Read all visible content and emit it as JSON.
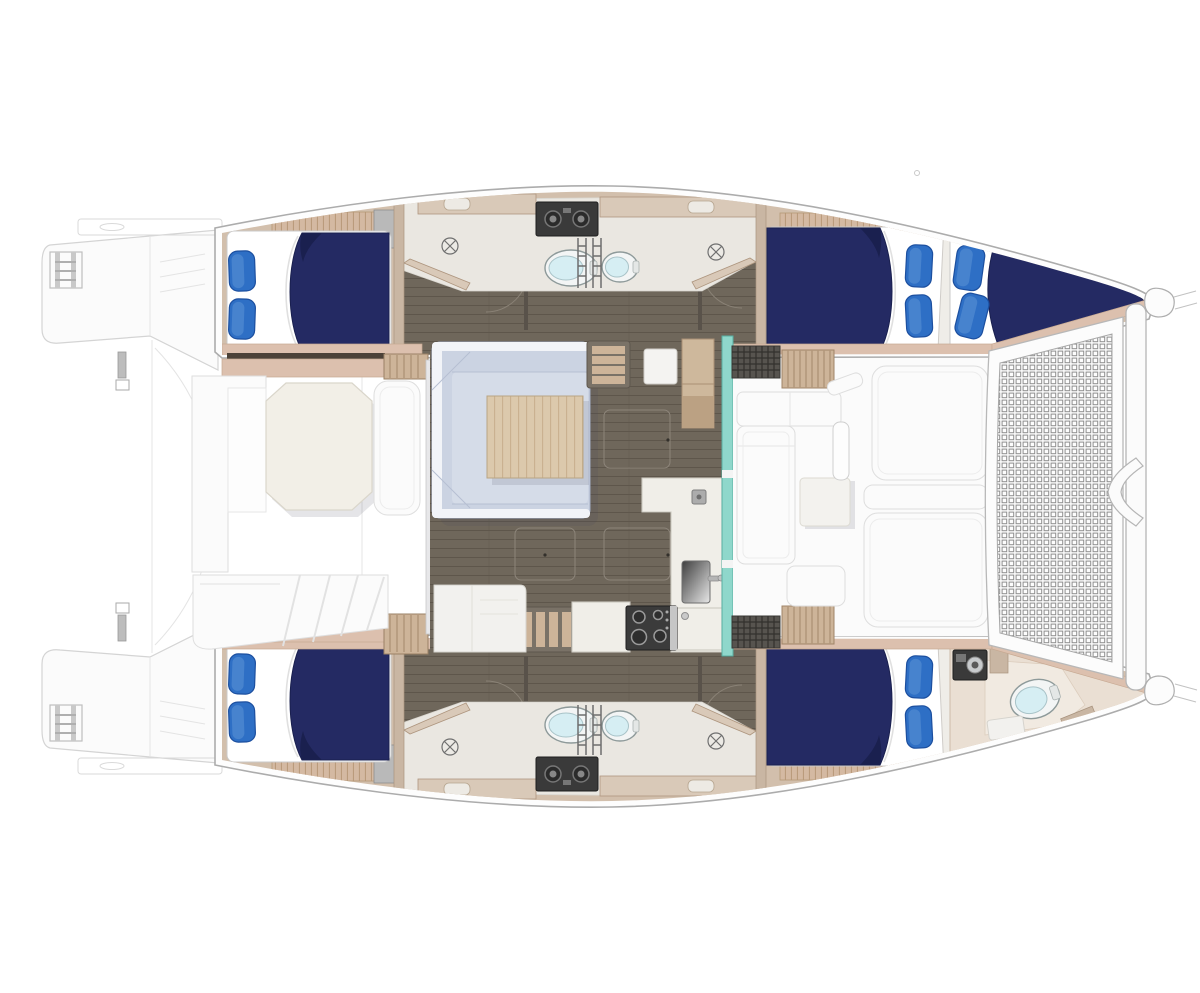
{
  "meta": {
    "diagram_type": "yacht-floor-plan",
    "vessel_type": "sailing-catamaran",
    "view": "top-down-deck-plan",
    "bow_direction": "right",
    "stern_direction": "left"
  },
  "palette": {
    "deck-white": "#FBFBFB",
    "deck-line": "#DEDEDE",
    "ghost-line": "#D4D4D4",
    "hull-stroke": "#ACACAC",
    "bed-navy": "#242A63",
    "bed-navy-dark": "#1A204F",
    "pillow-blue": "#2E6FC5",
    "pillow-blue-dark": "#1C4F9F",
    "wood-floor": "#6F675B",
    "wood-floor-line": "#5E564B",
    "wall-beige": "#D2BFAC",
    "wall-beige-dark": "#AE967F",
    "band-tan": "#DCC0AE",
    "slat-wood": "#D4B9A2",
    "slat-line": "#B89878",
    "step-wood": "#CDB499",
    "step-frame": "#7A7267",
    "bath-floor": "#EAE7E1",
    "fixture-beige": "#D9C9B8",
    "toilet-rim": "#F3F5F5",
    "toilet-bowl": "#D6EEF3",
    "toilet-stroke": "#8E9A9A",
    "sofa-blue": "#CBD3E2",
    "sofa-blue-light": "#D5DCE8",
    "sofa-stroke": "#A4AFC6",
    "table-wood": "#DCC9AC",
    "table-grain": "#C9B08E",
    "counter-white": "#F0EEE8",
    "counter-stroke": "#CCC9C1",
    "stove-dark": "#3B3B3B",
    "teal-glass": "#8FD7CB",
    "teal-stroke": "#58AFA2",
    "dark-panel": "#3A3A3A",
    "grate-dark": "#57544F",
    "head-floor": "#EADFD3",
    "tramp-line": "#8F8F8F"
  },
  "areas": [
    "stern-swim-platforms",
    "aft-cockpit",
    "saloon",
    "galley",
    "forward-deck-lounge",
    "bow-trampoline",
    "bow-crossbeam",
    "starboard-aft-cabin",
    "starboard-head-compartments",
    "starboard-forward-cabin",
    "forepeak-berth",
    "port-aft-cabin",
    "port-head-compartments",
    "port-forward-cabin",
    "forepeak-head"
  ],
  "counts": {
    "double-berths": 5,
    "pillows": 10,
    "toilets": 5,
    "shower-drains": 4,
    "head-compartments": 5,
    "boarding-ladders": 2,
    "sunpads": 3,
    "cockpit-tables": 1,
    "saloon-tables": 1,
    "stove-burners": 4
  },
  "icons": [
    "toilet-icon",
    "shower-drain-icon",
    "sink-icon",
    "stove-icon",
    "boarding-ladder-icon",
    "companionway-steps-icon",
    "trampoline-net-icon",
    "equipment-knob-panel-icon",
    "deck-grate-icon"
  ]
}
